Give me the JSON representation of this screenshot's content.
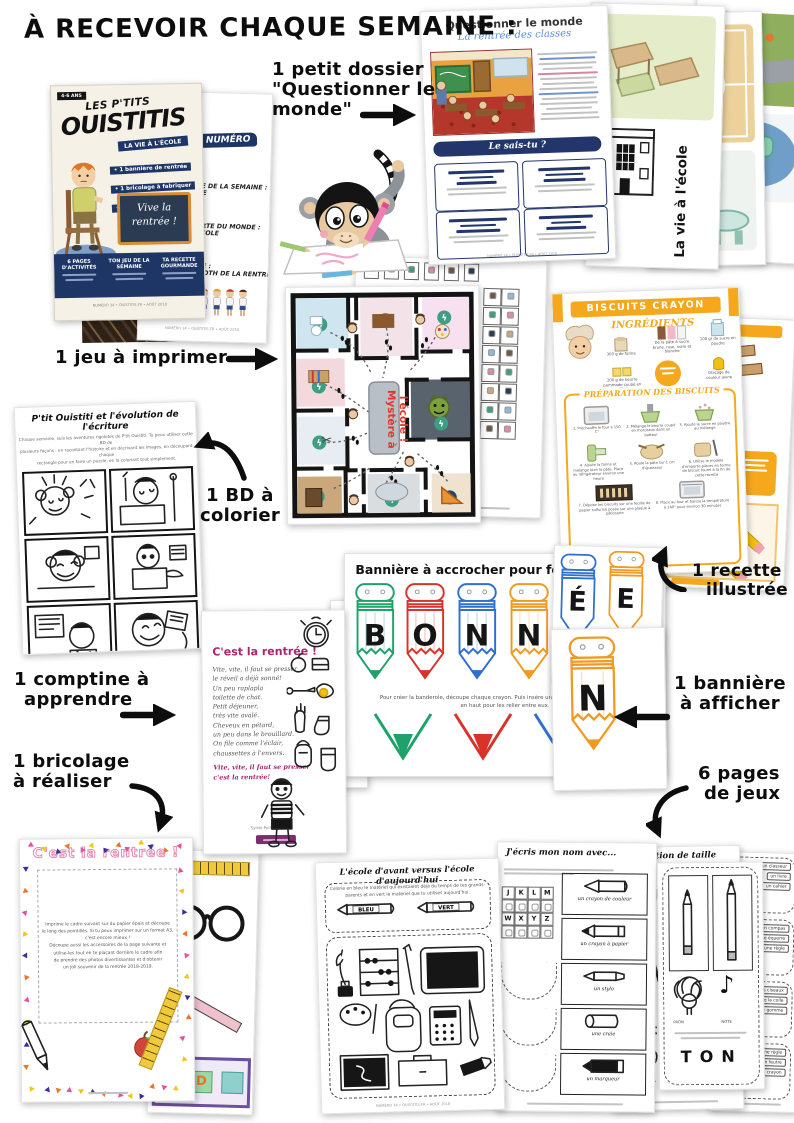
{
  "header": {
    "title": "À RECEVOIR CHAQUE SEMAINE :"
  },
  "annotations": {
    "dossier_l1": "1 petit dossier",
    "dossier_l2": "\"Questionner le",
    "dossier_l3": "monde\"",
    "jeu": "1 jeu à imprimer",
    "bd_l1": "1 BD à",
    "bd_l2": "colorier",
    "comptine_l1": "1 comptine à",
    "comptine_l2": "apprendre",
    "bricolage_l1": "1 bricolage",
    "bricolage_l2": "à réaliser",
    "recette_l1": "1 recette",
    "recette_l2": "illustrée",
    "banniere_l1": "1 bannière",
    "banniere_l2": "à afficher",
    "jeux_l1": "6 pages",
    "jeux_l2": "de jeux"
  },
  "cover": {
    "age": "4-6 ANS",
    "brand1": "LES P'TITS",
    "brand2": "OUISTITIS",
    "badge": "LA VIE À L'ÉCOLE",
    "b1": "• 1 bannière de rentrée",
    "b2": "• 1 bricolage à fabriquer",
    "b3": "• 1 histoire à colorier",
    "chalk1": "Vive la",
    "chalk2": "rentrée !",
    "col1": "6 PAGES D'ACTIVITÉS",
    "col2": "TON JEU DE LA SEMAINE",
    "col3": "TA RECETTE GOURMANDE",
    "footer": "NUMÉRO 34  •  OUISTITIS.FR  •  AOÛT 2018"
  },
  "toc": {
    "banner": "CE NUMÉRO",
    "i1a": "★ LA COMPTINE DE LA SEMAINE :",
    "i1b": "VIVE L'ÉCOLE",
    "i2a": "★ LA DÉCOUVERTE DU MONDE :",
    "i2b": "LA VIE À L'ÉCOLE",
    "i3a": "★ LE BRICOLAGE :",
    "i3b": "LE PHOTOBOOTH DE LA RENTRÉE"
  },
  "dossier": {
    "title": "Questionner le monde",
    "subtitle": "La rentrée des classes",
    "quiz": "Le sais-tu ?"
  },
  "vie": {
    "label": "La vie à l'école"
  },
  "maze": {
    "t1": "Mystère à",
    "t2": "l'école !"
  },
  "recette": {
    "title": "BISCUITS CRAYON",
    "ing_title": "INGRÉDIENTS",
    "ing1": "300 g de farine",
    "ing2": "200 g de beurre pommade coupé en cubes",
    "ing3": "De la pâte à sucre brune, rose, noire et blanche",
    "ing4": "100 gr de sucre en poudre",
    "ing5": "Glaçage de couleur jaune",
    "prep_title": "PRÉPARATION DES BISCUITS",
    "s1": "1. Préchauffe le four à 150 C°",
    "s2": "2. Mélange le beurre coupé en morceaux dans un batteur",
    "s3": "3. Ajoute le sucre en poudre au mélange",
    "s4": "4. Ajoute la farine et mélange bien la pâte. Place au réfrigérateur environ une heure",
    "s5": "5. Roule la pâte sur 1 cm d'épaisseur",
    "s6": "6. Utilise le modèle d'emporte-pièces en forme de biscuit fourni à la fin de cette recette",
    "s7": "7. Dépose tes biscuits sur une feuille de papier sulfurisé posée sur une plaque à pâtisserie",
    "s8": "8. Place au four et baisse la température à 140° pour environ 30 minutes"
  },
  "bd": {
    "title": "P'tit Ouistiti et l'évolution de l'écriture",
    "intro1": "Chaque semaine, suis les aventures rigolotes de P'tit Ouistiti. Tu peux utiliser cette BD de",
    "intro2": "plusieurs façons : en racontant l'histoire et en décrivant les images, en découpant chaque",
    "intro3": "rectangle pour en faire un puzzle, en la coloriant tout simplement."
  },
  "banniere": {
    "title": "Bannière à accrocher pour fêter la rentrée",
    "l1": "B",
    "l2": "O",
    "l3": "N",
    "l4": "N",
    "l5": "É",
    "l6": "E",
    "l7": "N",
    "cap1": "Pour créer la banderole, découpe chaque crayon. Puis insère une ficelle dans les trous situés",
    "cap2": "en haut pour les relier entre eux."
  },
  "comptine": {
    "title": "C'est la rentrée !",
    "v1": "Vite, vite, il faut se presser",
    "v2": "le réveil a déjà sonné!",
    "v3": "Un peu raplapla",
    "v4": "toilette de chat.",
    "v5": "Petit déjeuner,",
    "v6": "très vite avalé.",
    "v7": "Cheveux en pétard,",
    "v8": "un peu dans le brouillard.",
    "v9": "On file comme l'éclair,",
    "v10": "chaussettes à l'envers.",
    "r1": "Vite, vite, il faut se presser",
    "r2": "c'est la rentrée!",
    "author": "- Sylvie Poillevé -"
  },
  "bricolage": {
    "title": "C'est la rentrée !",
    "instr1": "Imprime le cadre suivant sur du papier épais et découpe",
    "instr2": "le long des pointillés. Si tu peux imprimer sur un format A3,",
    "instr3": "c'est encore mieux !",
    "instr4": "Découpe aussi les accessoires de la page suivante et",
    "instr5": "utilise-les tout en te plaçant derrière le cadre afin",
    "instr6": "de prendre des photos divertissantes et d'obtenir",
    "instr7": "un joli souvenir de la rentrée 2018-2019.",
    "foot1": "Premier jour de",
    "foot2": "2018/2019",
    "block_letter": "D"
  },
  "jeux": {
    "p1_title": "L'école d'avant versus l'école d'aujourd'hui",
    "p1_i1": "Colorie en bleu le matériel qui existaient déjà du temps de tes grands-",
    "p1_i2": "parents et en vert le matériel que tu utilises aujourd'hui.",
    "bleu": "BLEU",
    "vert": "VERT",
    "p2_title": "J'écris mon nom avec...",
    "g1": "J",
    "g2": "K",
    "g3": "L",
    "g4": "M",
    "g5": "W",
    "g6": "X",
    "g7": "Y",
    "g8": "Z",
    "it1": "un crayon de couleur",
    "it2": "un crayon à papier",
    "it3": "un stylo",
    "it4": "une craie",
    "it5": "un marqueur",
    "p3_title": "Question de taille",
    "paon": "PAON",
    "note": "NOTE",
    "ton": "TON",
    "w1": "un classeur",
    "w2": "un livre",
    "w3": "un cahier",
    "w4": "un compas",
    "w5": "une équerre",
    "w6": "une règle",
    "w7": "des ciseaux",
    "w8": "de la colle",
    "w9": "une gomme",
    "w10": "une règle",
    "w11": "un feutre",
    "w12": "un crayon"
  },
  "footer_meta": "NUMÉRO 34  •  OUISTITIS.FR  •  AOÛT 2018",
  "colors": {
    "navy": "#1e3666",
    "orange": "#f6a81c",
    "magenta": "#a8256e",
    "banner_green": "#1fa26a",
    "banner_red": "#d8332a",
    "banner_blue": "#2f6fd0",
    "banner_orange": "#f09a23",
    "maze_teal": "#3d9e82",
    "maze_red": "#e0362c"
  }
}
